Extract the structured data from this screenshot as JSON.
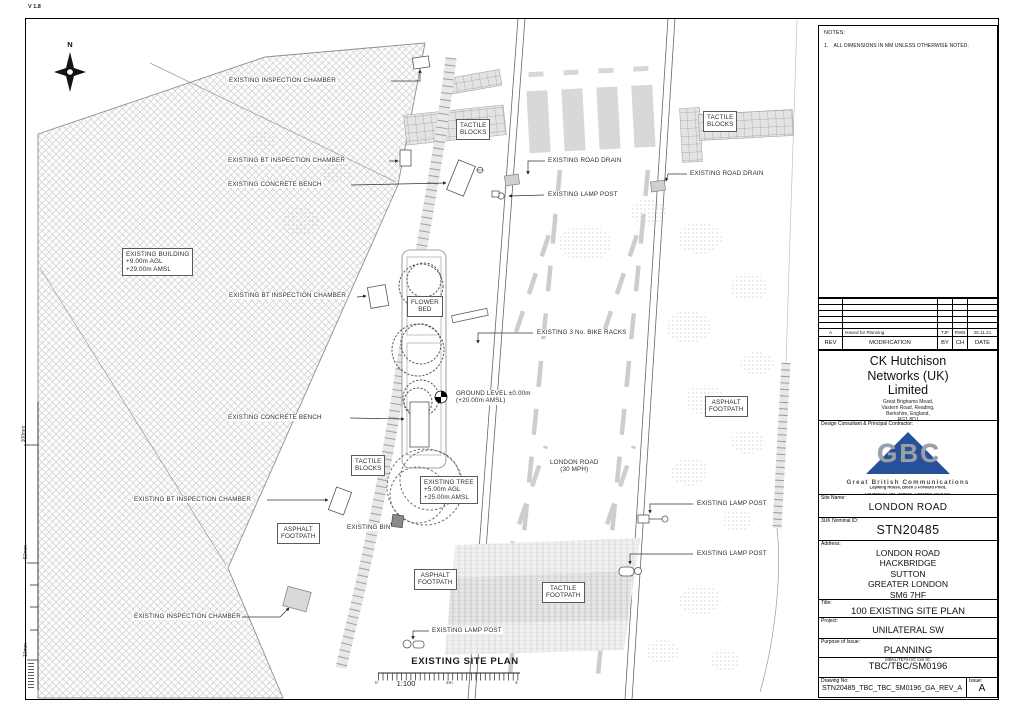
{
  "meta": {
    "version": "V 1.8"
  },
  "plan": {
    "north_label": "N",
    "title": "EXISTING SITE PLAN",
    "scale": {
      "left": "0",
      "ratio": "1:100",
      "mid": "2m",
      "right": "4"
    },
    "ruler": [
      "100mm",
      "50mm",
      "10mm"
    ],
    "labels": [
      {
        "text": "EXISTING INSPECTION CHAMBER",
        "x": 228,
        "y": 77
      },
      {
        "text": "EXISTING BT INSPECTION CHAMBER",
        "x": 227,
        "y": 157
      },
      {
        "text": "EXISTING CONCRETE BENCH",
        "x": 227,
        "y": 181
      },
      {
        "lines": [
          "TACTILE",
          "BLOCKS"
        ],
        "boxed": true,
        "x": 456,
        "y": 119
      },
      {
        "text": "EXISTING ROAD DRAIN",
        "x": 547,
        "y": 157
      },
      {
        "lines": [
          "TACTILE",
          "BLOCKS"
        ],
        "boxed": true,
        "x": 703,
        "y": 111
      },
      {
        "text": "EXISTING ROAD DRAIN",
        "x": 689,
        "y": 170
      },
      {
        "text": "EXISTING LAMP POST",
        "x": 547,
        "y": 191
      },
      {
        "lines": [
          "EXISTING BUILDING",
          "+9.00m AGL",
          "+29.00m AMSL"
        ],
        "boxed": true,
        "align": "left",
        "x": 122,
        "y": 248
      },
      {
        "text": "EXISTING BT INSPECTION CHAMBER",
        "x": 228,
        "y": 292
      },
      {
        "lines": [
          "FLOWER",
          "BED"
        ],
        "boxed": true,
        "x": 407,
        "y": 296
      },
      {
        "text": "EXISTING 3 No. BIKE RACKS",
        "x": 536,
        "y": 329
      },
      {
        "lines": [
          "GROUND LEVEL ±0.00m",
          "(+20.00m AMSL)"
        ],
        "align": "left",
        "x": 455,
        "y": 390
      },
      {
        "lines": [
          "ASPHALT",
          "FOOTPATH"
        ],
        "boxed": true,
        "x": 705,
        "y": 396
      },
      {
        "text": "EXISTING CONCRETE BENCH",
        "x": 227,
        "y": 414
      },
      {
        "lines": [
          "TACTILE",
          "BLOCKS"
        ],
        "boxed": true,
        "x": 351,
        "y": 455
      },
      {
        "lines": [
          "LONDON ROAD",
          "(30 MPH)"
        ],
        "x": 549,
        "y": 459
      },
      {
        "lines": [
          "EXISTING TREE",
          "+5.00m AGL",
          "+25.00m AMSL"
        ],
        "boxed": true,
        "align": "left",
        "x": 420,
        "y": 476
      },
      {
        "text": "EXISTING BT INSPECTION CHAMBER",
        "x": 133,
        "y": 496
      },
      {
        "lines": [
          "ASPHALT",
          "FOOTPATH"
        ],
        "boxed": true,
        "x": 277,
        "y": 523
      },
      {
        "text": "EXISTING BIN",
        "x": 346,
        "y": 524
      },
      {
        "text": "EXISTING LAMP POST",
        "x": 696,
        "y": 500
      },
      {
        "text": "EXISTING LAMP POST",
        "x": 696,
        "y": 550
      },
      {
        "lines": [
          "ASPHALT",
          "FOOTPATH"
        ],
        "boxed": true,
        "x": 414,
        "y": 569
      },
      {
        "lines": [
          "TACTILE",
          "FOOTPATH"
        ],
        "boxed": true,
        "x": 542,
        "y": 582
      },
      {
        "text": "EXISTING INSPECTION CHAMBER",
        "x": 133,
        "y": 613
      },
      {
        "text": "EXISTING LAMP POST",
        "x": 431,
        "y": 627
      }
    ]
  },
  "titleblock": {
    "notes": {
      "heading": "NOTES:",
      "items": [
        "1. ALL DIMENSIONS IN MM UNLESS OTHERWISE NOTED."
      ]
    },
    "revision_table": {
      "headers": [
        "REV",
        "MODIFICATION",
        "BY",
        "CH",
        "DATE"
      ],
      "rows": [
        [
          "A",
          "Issued for Planning",
          "TJF",
          "RWB",
          "26.11.21"
        ]
      ],
      "empty_row_count": 5
    },
    "company": {
      "name_lines": [
        "CK Hutchison",
        "Networks (UK)",
        "Limited"
      ],
      "address_lines": [
        "Great Brighams Mead,",
        "Vastern Road, Reading,",
        "Berkshire, England,",
        "RG1 8DJ"
      ]
    },
    "contractor": {
      "label": "Design Consultant & Principal Contractor:",
      "logo_text": "GBC",
      "name": "Great British Communications",
      "address_lines": [
        "Lapwing House, Block 3 Forward Point,",
        "Tan House Lane, Widnes, Cheshire, WA8 0SL",
        "t. 44 (0)151 420 4128"
      ],
      "website": "www.gbcomms.co.uk"
    },
    "site_name": {
      "label": "Site Name:",
      "value": "LONDON ROAD"
    },
    "nominal_id": {
      "label": "3UK Nominal ID:",
      "value": "STN20485"
    },
    "address": {
      "label": "Address:",
      "lines": [
        "LONDON ROAD",
        "HACKBRIDGE",
        "SUTTON",
        "GREATER LONDON",
        "SM6 7HF"
      ]
    },
    "title": {
      "label": "Title:",
      "value": "100 EXISTING SITE PLAN"
    },
    "project": {
      "label": "Project:",
      "value": "UNILATERAL SW"
    },
    "purpose": {
      "label": "Purpose of Issue:",
      "value": "PLANNING"
    },
    "cell_id": {
      "label": "MBNL/TEF/H3G Cell ID:",
      "value": "TBC/TBC/SM0196"
    },
    "drawing_no": {
      "label": "Drawing No:",
      "value": "STN20485_TBC_TBC_SM0196_GA_REV_A"
    },
    "issue": {
      "label": "Issue:",
      "value": "A"
    }
  },
  "colors": {
    "accent_blue": "#27509b",
    "line": "#000000",
    "light_fill": "#d8d8d8",
    "hatch": "#c6c6c6"
  }
}
